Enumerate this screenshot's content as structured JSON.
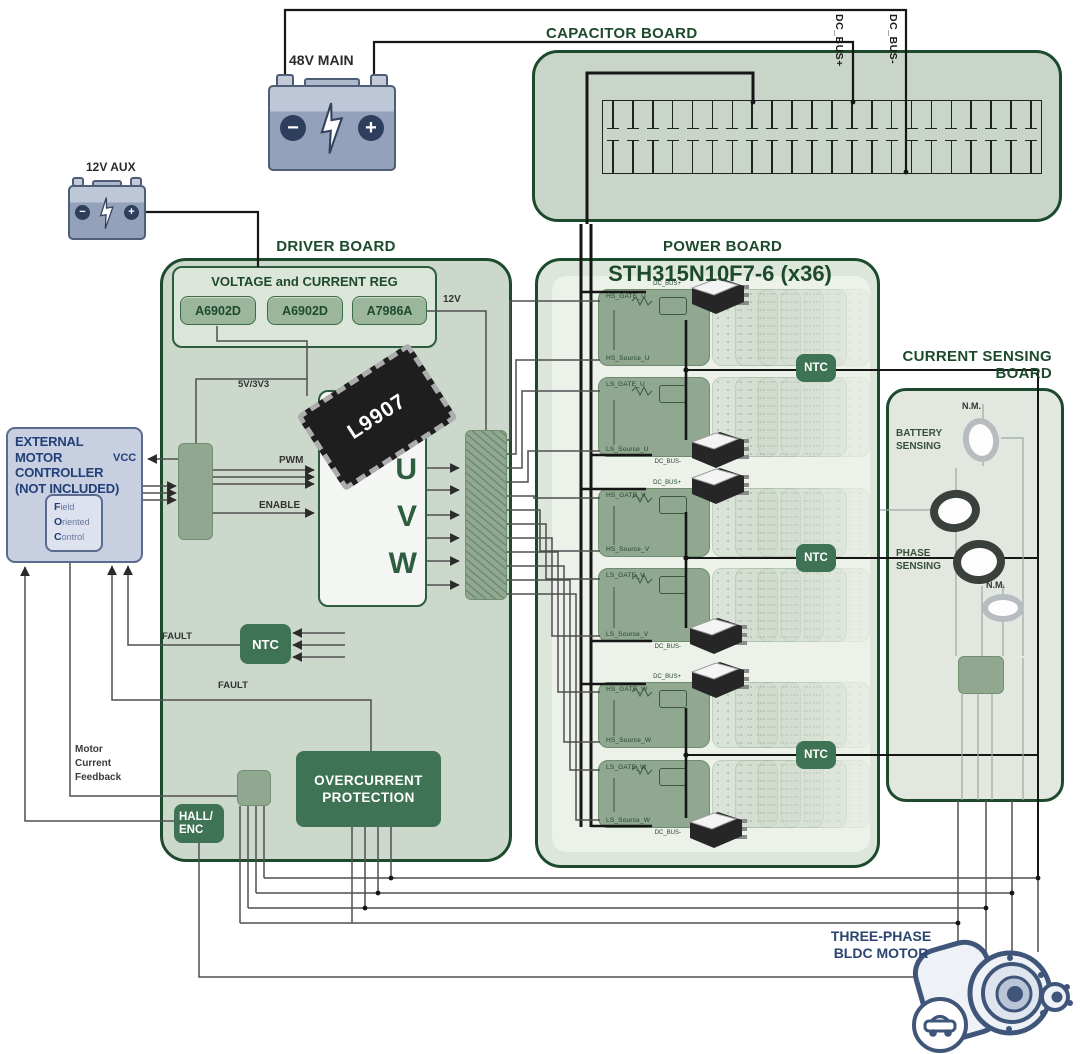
{
  "batteries": {
    "main_label": "48V MAIN",
    "aux_label": "12V AUX",
    "minus": "−",
    "plus": "+"
  },
  "capacitor_board": {
    "title": "CAPACITOR BOARD",
    "cap_count": 22,
    "dc_bus_plus": "DC_BUS+",
    "dc_bus_minus": "DC_BUS-"
  },
  "driver_board": {
    "title": "DRIVER BOARD",
    "reg": {
      "title": "VOLTAGE and CURRENT REG",
      "chips": [
        "A6902D",
        "A6902D",
        "A7986A"
      ]
    },
    "rail_12v": "12V",
    "rail_5v": "5V/3V3",
    "pwm": "PWM",
    "enable": "ENABLE",
    "vcc": "VCC",
    "fault_ntc": "FAULT",
    "fault_ocp": "FAULT",
    "ntc": "NTC",
    "l9907": {
      "part": "L9907",
      "u": "U",
      "v": "V",
      "w": "W"
    },
    "overcurrent_line1": "OVERCURRENT",
    "overcurrent_line2": "PROTECTION",
    "hall_line1": "HALL/",
    "hall_line2": "ENC",
    "feedback_line1": "Motor",
    "feedback_line2": "Current",
    "feedback_line3": "Feedback"
  },
  "controller": {
    "title_lines": [
      "EXTERNAL",
      "MOTOR",
      "CONTROLLER",
      "(NOT INCLUDED)"
    ],
    "foc": [
      {
        "lead": "F",
        "rest": "ield"
      },
      {
        "lead": "O",
        "rest": "riented"
      },
      {
        "lead": "C",
        "rest": "ontrol"
      }
    ]
  },
  "power_board": {
    "title": "POWER BOARD",
    "subtitle": "STH315N10F7-6 (x36)",
    "ntc": "NTC",
    "blocks": [
      {
        "gate": "HS_GATE_U",
        "source": "HS_Source_U",
        "bus": "DC_BUS+"
      },
      {
        "gate": "LS_GATE_U",
        "source": "LS_Source_U",
        "bus": "DC_BUS-"
      },
      {
        "gate": "HS_GATE_V",
        "source": "HS_Source_V",
        "bus": "DC_BUS+"
      },
      {
        "gate": "LS_GATE_V",
        "source": "LS_Source_V",
        "bus": "DC_BUS-"
      },
      {
        "gate": "HS_GATE_W",
        "source": "HS_Source_W",
        "bus": "DC_BUS+"
      },
      {
        "gate": "LS_GATE_W",
        "source": "LS_Source_W",
        "bus": "DC_BUS-"
      }
    ]
  },
  "sensing_board": {
    "title_line1": "CURRENT SENSING",
    "title_line2": "BOARD",
    "nm_top": "N.M.",
    "nm_bottom": "N.M.",
    "battery_line1": "BATTERY",
    "battery_line2": "SENSING",
    "phase_line1": "PHASE",
    "phase_line2": "SENSING"
  },
  "motor": {
    "label_line1": "THREE-PHASE",
    "label_line2": "BLDC MOTOR"
  }
}
